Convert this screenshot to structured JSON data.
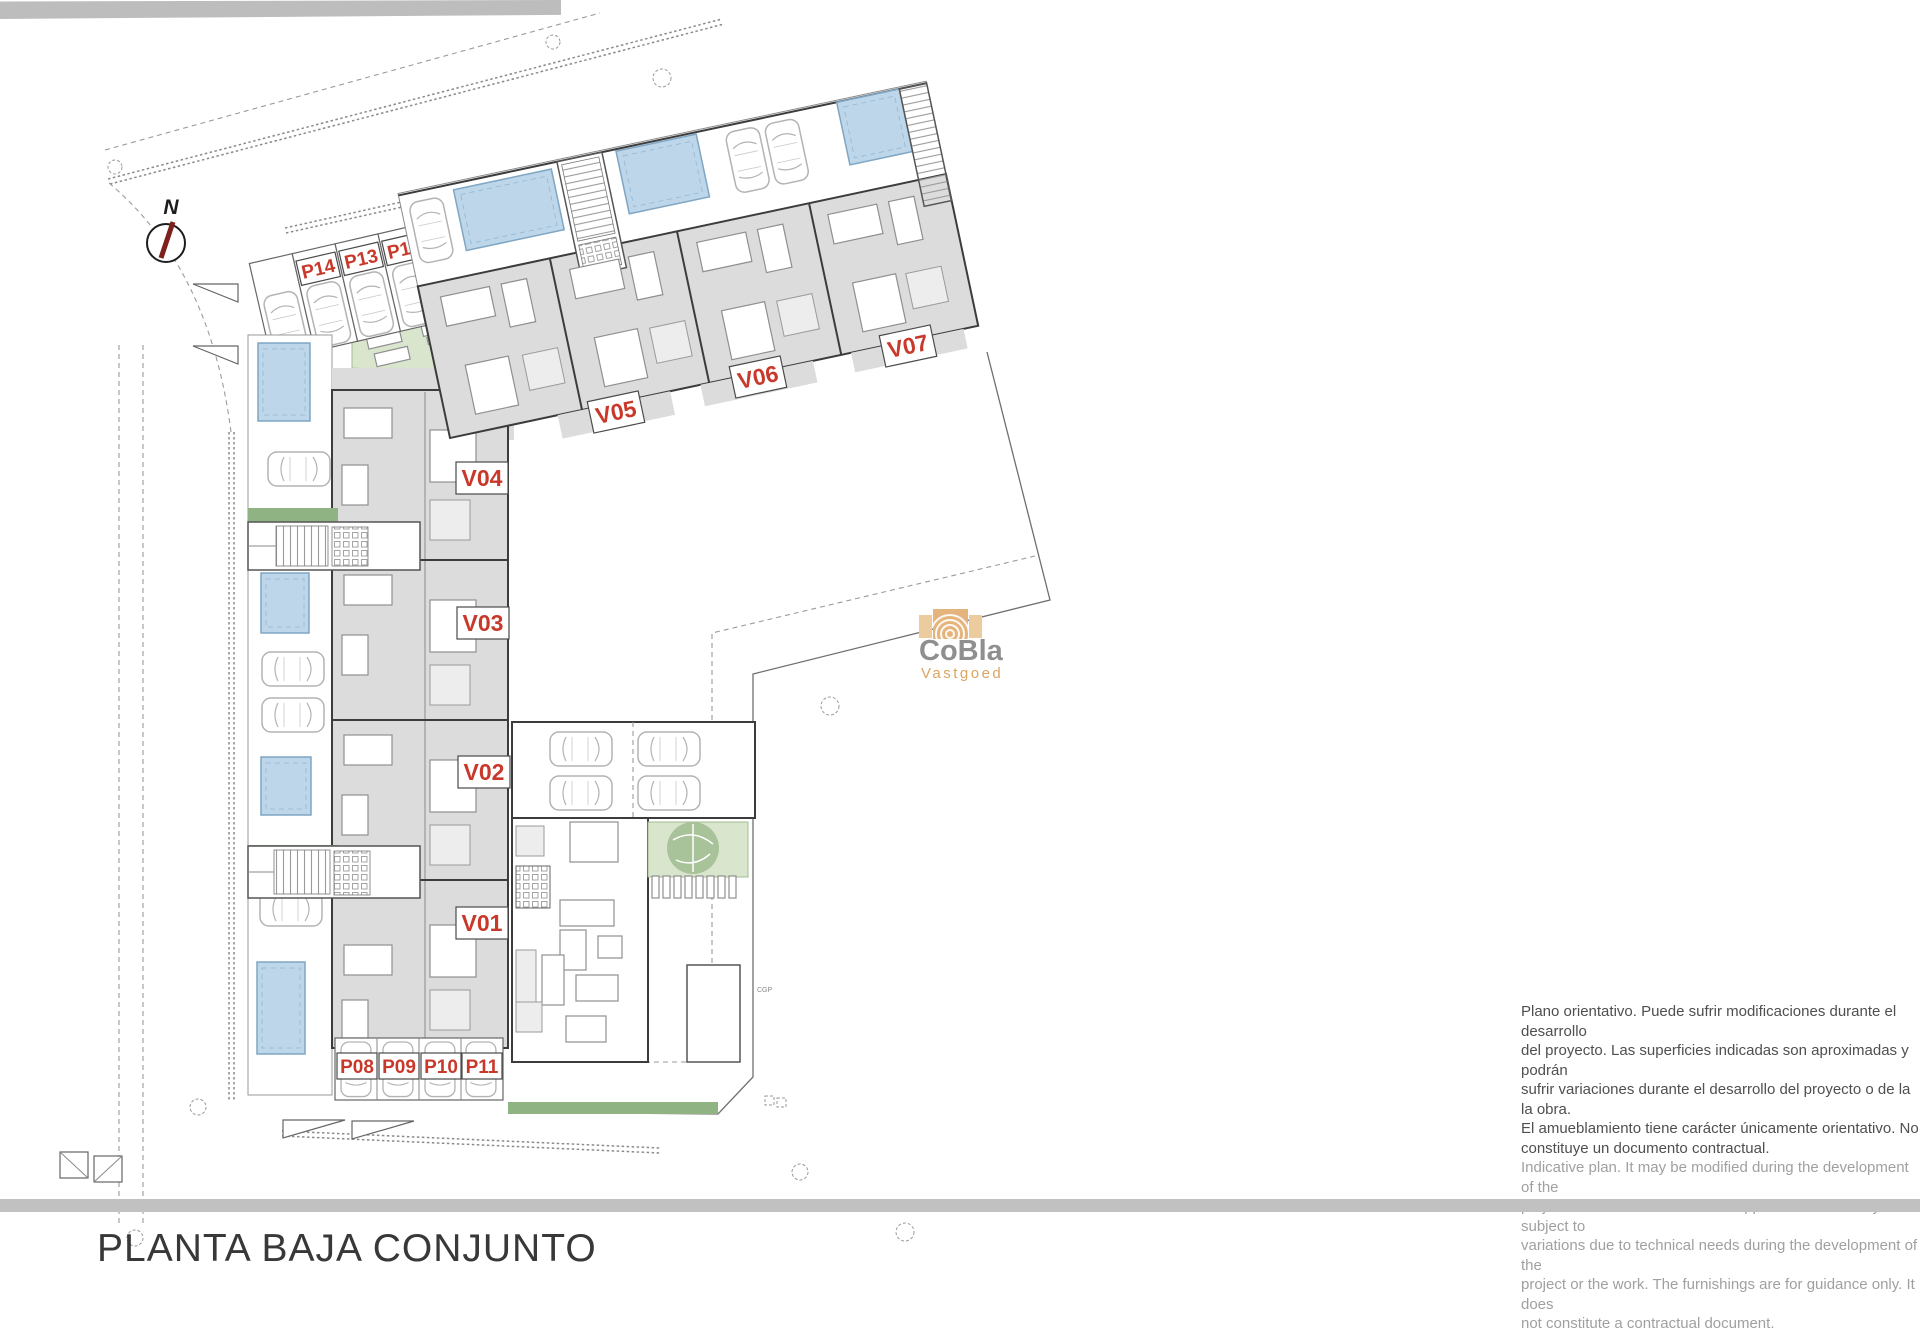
{
  "page": {
    "title": "PLANTA BAJA CONJUNTO"
  },
  "plan": {
    "north_label": "N",
    "units": [
      {
        "id": "v01",
        "label": "V01"
      },
      {
        "id": "v02",
        "label": "V02"
      },
      {
        "id": "v03",
        "label": "V03"
      },
      {
        "id": "v04",
        "label": "V04"
      },
      {
        "id": "v05",
        "label": "V05"
      },
      {
        "id": "v06",
        "label": "V06"
      },
      {
        "id": "v07",
        "label": "V07"
      }
    ],
    "parking": [
      {
        "id": "p08",
        "label": "P08"
      },
      {
        "id": "p09",
        "label": "P09"
      },
      {
        "id": "p10",
        "label": "P10"
      },
      {
        "id": "p11",
        "label": "P11"
      },
      {
        "id": "p12",
        "label": "P12"
      },
      {
        "id": "p13",
        "label": "P13"
      },
      {
        "id": "p14",
        "label": "P14"
      }
    ],
    "utility_box_label": "CGP"
  },
  "logo": {
    "brand": "CoBla",
    "subtitle": "Vastgoed"
  },
  "disclaimer": {
    "spanish": [
      "Plano orientativo. Puede sufrir modificaciones durante el desarrollo",
      "del proyecto. Las superficies indicadas son aproximadas y podrán",
      "sufrir variaciones durante el desarrollo del proyecto o de la la obra.",
      "El amueblamiento tiene carácter únicamente orientativo. No",
      "constituye un documento contractual."
    ],
    "english": [
      "Indicative plan. It may be modified during the development of the",
      "project. The areas indicated are approximate and may be subject to",
      "variations due to technical needs during the development of the",
      "project or the work. The furnishings are for guidance only. It does",
      "not constitute a contractual document."
    ]
  },
  "colors": {
    "label_red": "#c8392b",
    "pool_fill": "#bdd6e9",
    "pool_edge": "#7fa6c4",
    "room_gray": "#dcdcdc",
    "wall_dark": "#3c3c3c",
    "green_light": "#d9e5cc",
    "green_strip": "#8fb383",
    "bar_gray": "#c1c1c1",
    "logo_tan": "#dca45f",
    "logo_gray": "#8f8f8f"
  }
}
